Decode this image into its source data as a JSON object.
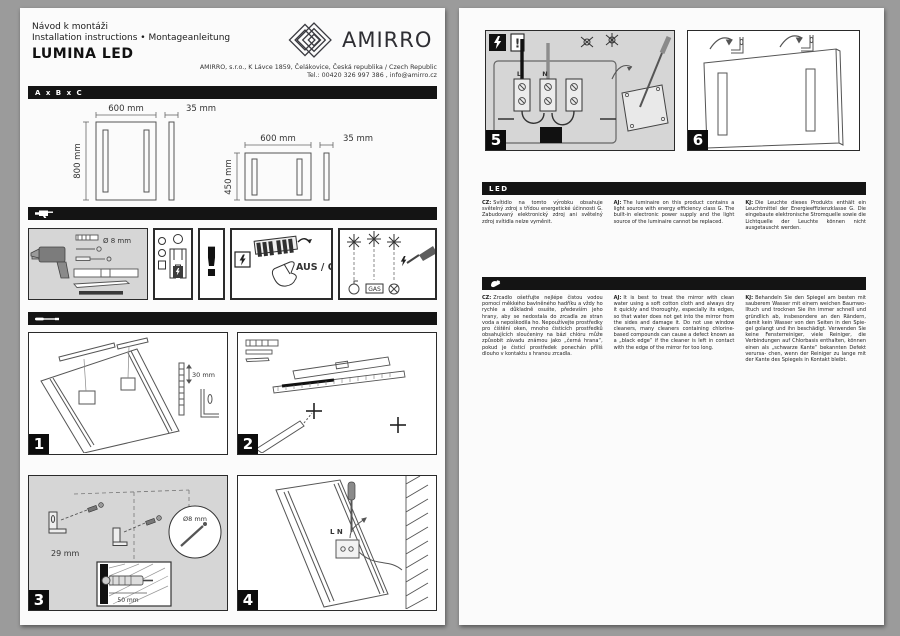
{
  "page_left": {
    "header": {
      "line1": "Návod k montáži",
      "line2": "Installation instructions • Montageanleitung",
      "product": "LUMINA LED",
      "brand": "AMIRRO",
      "address1": "AMIRRO, s.r.o., K Lávce 1859, Čelákovice, Česká republika / Czech Republic",
      "address2": "Tel.: 00420 326 997 386 , info@amirro.cz"
    },
    "size_bar": "A x B x C",
    "mirrors": [
      {
        "width": "600 mm",
        "depth": "35 mm",
        "height": "800 mm"
      },
      {
        "width": "600 mm",
        "depth": "35 mm",
        "height": "450 mm"
      }
    ],
    "icons_row": {
      "drill_bit": "Ø 8 mm",
      "warning_mark": "!",
      "power_off": "AUS / OFF",
      "gas": "GAS"
    },
    "steps": {
      "s1": {
        "num": "1",
        "offset": "30 mm"
      },
      "s2": {
        "num": "2"
      },
      "s3": {
        "num": "3",
        "spacing": "29 mm",
        "screw": "50 mm",
        "hole": "Ø8 mm"
      },
      "s4": {
        "num": "4",
        "terminals": "L N"
      }
    }
  },
  "page_right": {
    "steps": {
      "s5": {
        "num": "5",
        "warning_mark": "!",
        "live": "L",
        "neutral": "N"
      },
      "s6": {
        "num": "6"
      }
    },
    "led_section": {
      "bar": "LED",
      "cz": {
        "label": "CZ:",
        "text": "Svítidlo na tomto výrobku obsahuje světelný zdroj s třídou energetické účinnosti G. Zabudovaný elektronický zdroj ani světelný zdroj svítidla nelze vyměnit."
      },
      "en": {
        "label": "AJ:",
        "text": "The luminaire on this product contains a light source with energy efficiency class G. The built-in electronic power supply and the light source of the luminaire cannot be replaced."
      },
      "de": {
        "label": "KJ:",
        "text": "Die Leuchte dieses Produkts enthält ein Leuchtmittel der Energieeffizienzklasse G. Die eingebaute elektronische Stromquelle sowie die Lichtquelle der Leuchte können nicht ausgetauscht werden."
      }
    },
    "care_section": {
      "cz": {
        "label": "CZ:",
        "text": "Zrcadlo ošetřujte nejlépe čistou vodou pomocí měkkého bavlněného hadříku a vždy ho rychle a důkladně osušte, především jeho hrany, aby se nedostala do zrcadla ze stran voda a nepoškodila ho. Nepoužívejte prostředky pro čištění oken, mnoho čisticích prostředků obsahujících sloučeniny na bázi chlóru může způsobit závadu známou jako „černá hrana“, pokud je čisticí prostředek ponechán příliš dlouho v kontaktu s hranou zrcadla."
      },
      "en": {
        "label": "AJ:",
        "text": "It is best to treat the mirror with clean water using a soft cotton cloth and always dry it quickly and thoroughly, especially its edges, so that water does not get into the mirror from the sides and damage it. Do not use window cleaners, many cleaners containing chlorine-based compounds can cause a defect known as a „black edge“ if the cleaner is left in contact with the edge of the mirror for too long."
      },
      "de": {
        "label": "KJ:",
        "text": "Behandeln Sie den Spiegel am besten mit sauberem Wasser mit einem weichen Baumwo- lltuch und trocknen Sie ihn immer schnell und gründlich ab, insbesondere an den Rändern, damit kein Wasser von den Seiten in den Spie- gel golangt und ihn beschädigt. Verwenden Sie keine Fensterreiniger, viele Reiniger, die Verbindungen auf Chlorbasis enthalten, können einen als „schwarze Kante“ bekannten Defekt verursa- chen, wenn der Reiniger zu lange mit der Kante des Spiegels in Kontakt bleibt."
      }
    }
  }
}
